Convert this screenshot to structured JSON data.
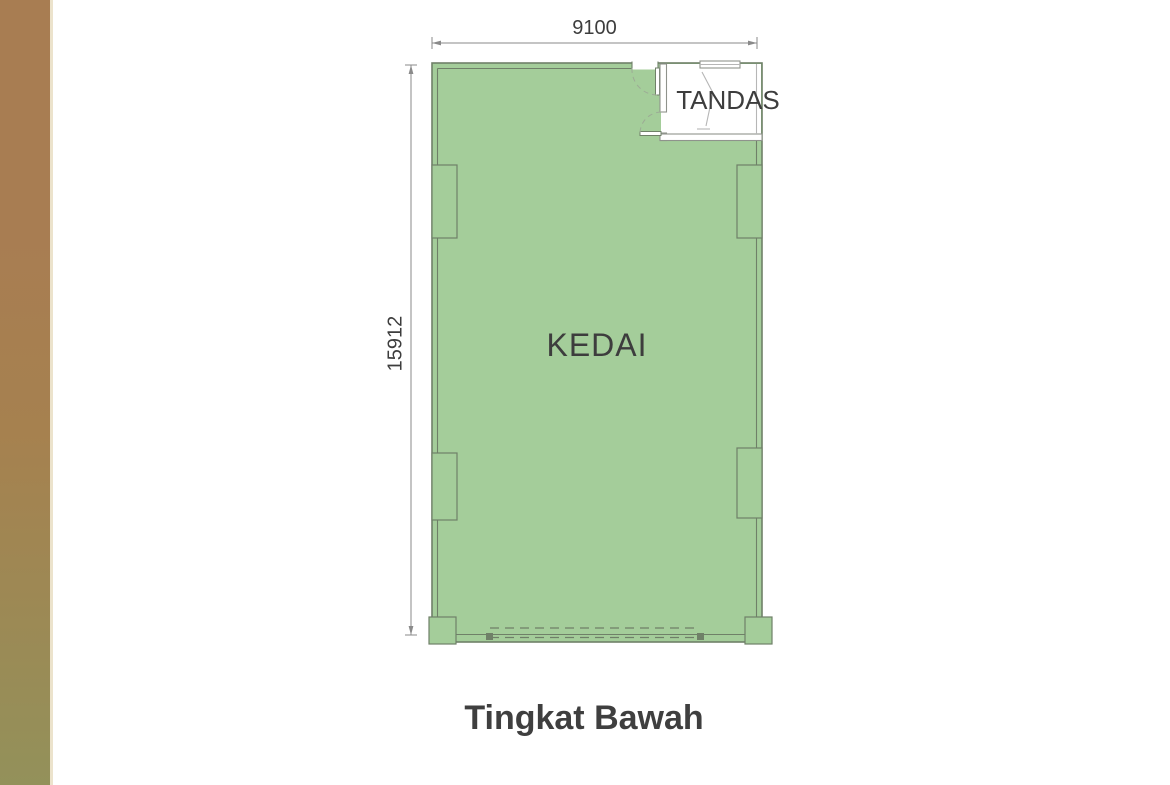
{
  "plan": {
    "rooms": [
      {
        "id": "kedai",
        "label": "KEDAI"
      },
      {
        "id": "tandas",
        "label": "TANDAS"
      }
    ],
    "dimensions": {
      "width": "9100",
      "height": "15912"
    },
    "caption": "Tingkat Bawah"
  },
  "colors": {
    "floor_fill": "#a4cd9a",
    "wall_line": "#6f8068",
    "tandas_line": "#8f938c",
    "fixture_line": "#b6b6b6",
    "dim_line": "#8a8a8a",
    "text_color": "#3d3d3d",
    "strip_top": "#a87d52",
    "strip_mid": "#a6814f",
    "strip_bottom": "#93915a",
    "strip_border": "#ece3cc"
  }
}
